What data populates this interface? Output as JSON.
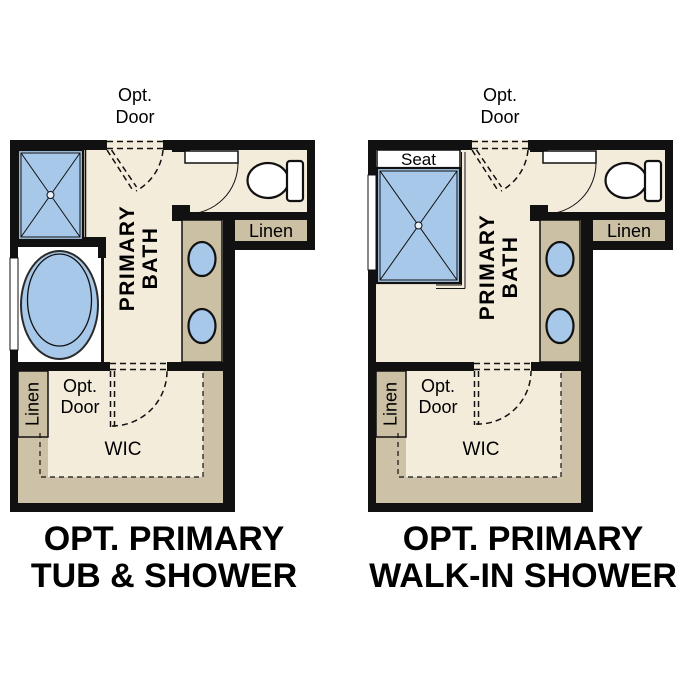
{
  "colors": {
    "wall": "#111111",
    "floor_cream": "#f3ecdb",
    "wic_taupe": "#cdc1a7",
    "closet_tan": "#cbbfa4",
    "fixture_blue": "#a7c8e8",
    "drain_fill": "#e8f0fa",
    "background": "#ffffff",
    "text": "#000000"
  },
  "plans": [
    {
      "id": "opt-primary-tub-and-shower",
      "opt_door_top": [
        "Opt.",
        "Door"
      ],
      "room_label": [
        "PRIMARY",
        "BATH"
      ],
      "linen_upper_label": "Linen",
      "linen_wic_label": "Linen",
      "opt_door_wic": [
        "Opt.",
        "Door"
      ],
      "wic_label": "WIC",
      "title": [
        "OPT. PRIMARY",
        "TUB & SHOWER"
      ]
    },
    {
      "id": "opt-primary-walk-in-shower",
      "seat_label": "Seat",
      "opt_door_top": [
        "Opt.",
        "Door"
      ],
      "room_label": [
        "PRIMARY",
        "BATH"
      ],
      "linen_upper_label": "Linen",
      "linen_wic_label": "Linen",
      "opt_door_wic": [
        "Opt.",
        "Door"
      ],
      "wic_label": "WIC",
      "title": [
        "OPT. PRIMARY",
        "WALK-IN SHOWER"
      ]
    }
  ]
}
